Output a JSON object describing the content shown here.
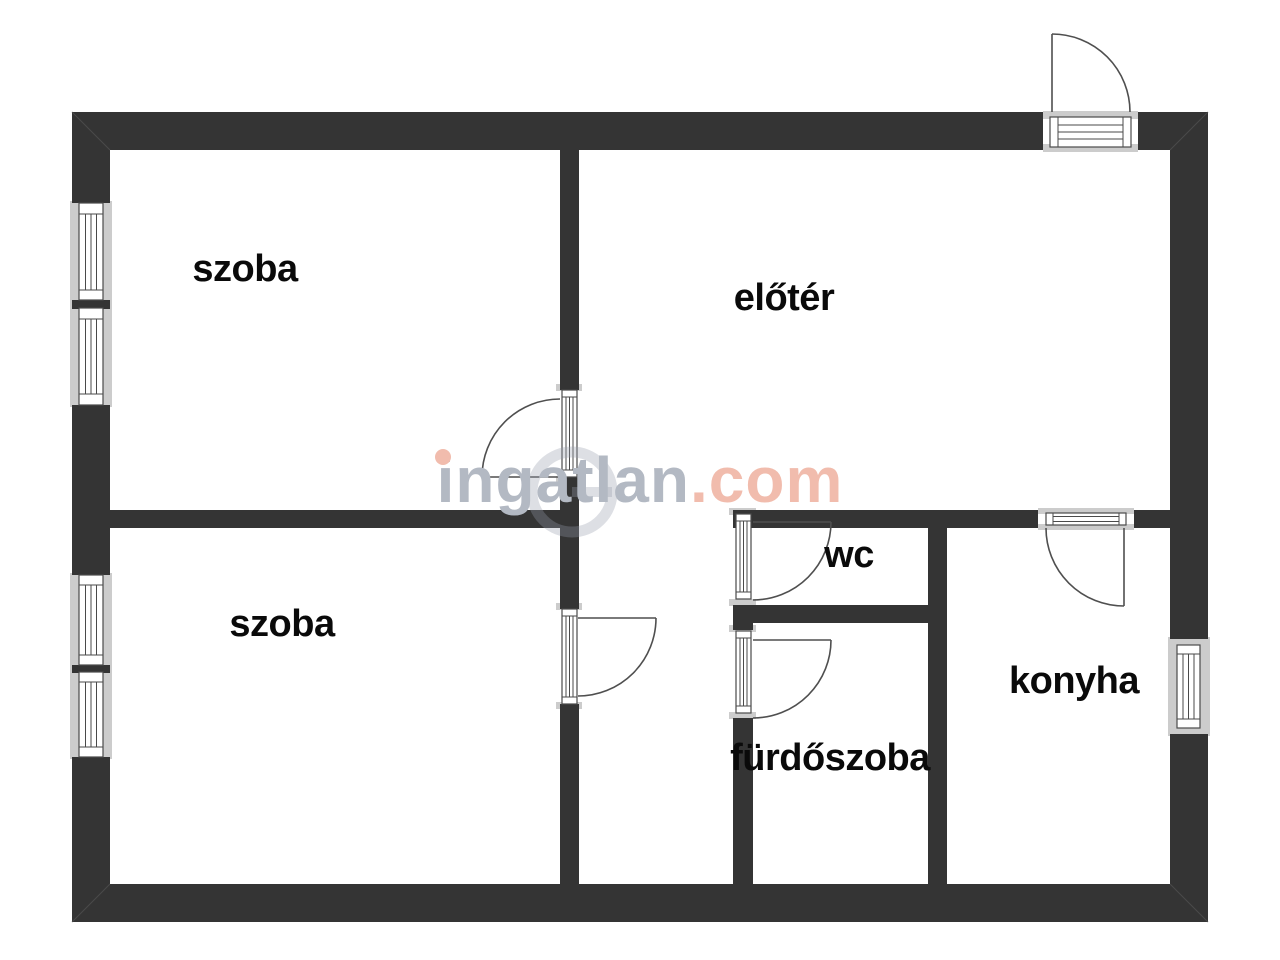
{
  "plan": {
    "type": "floorplan",
    "rooms": [
      {
        "id": "szoba-felso",
        "label": "szoba"
      },
      {
        "id": "eloter",
        "label": "előtér"
      },
      {
        "id": "szoba-also",
        "label": "szoba"
      },
      {
        "id": "wc",
        "label": "wc"
      },
      {
        "id": "furdoszoba",
        "label": "fürdőszoba"
      },
      {
        "id": "konyha",
        "label": "konyha"
      }
    ]
  },
  "watermark": {
    "brand": "ingatlan",
    "tld": ".com",
    "brand_color": "#b3b9c3",
    "tld_color": "#f1bcad"
  },
  "colors": {
    "wall": "#343434",
    "window_sill": "#cccccc",
    "frame_line": "#4a4a4a",
    "background": "#ffffff",
    "label_text": "#0a0a0a"
  }
}
